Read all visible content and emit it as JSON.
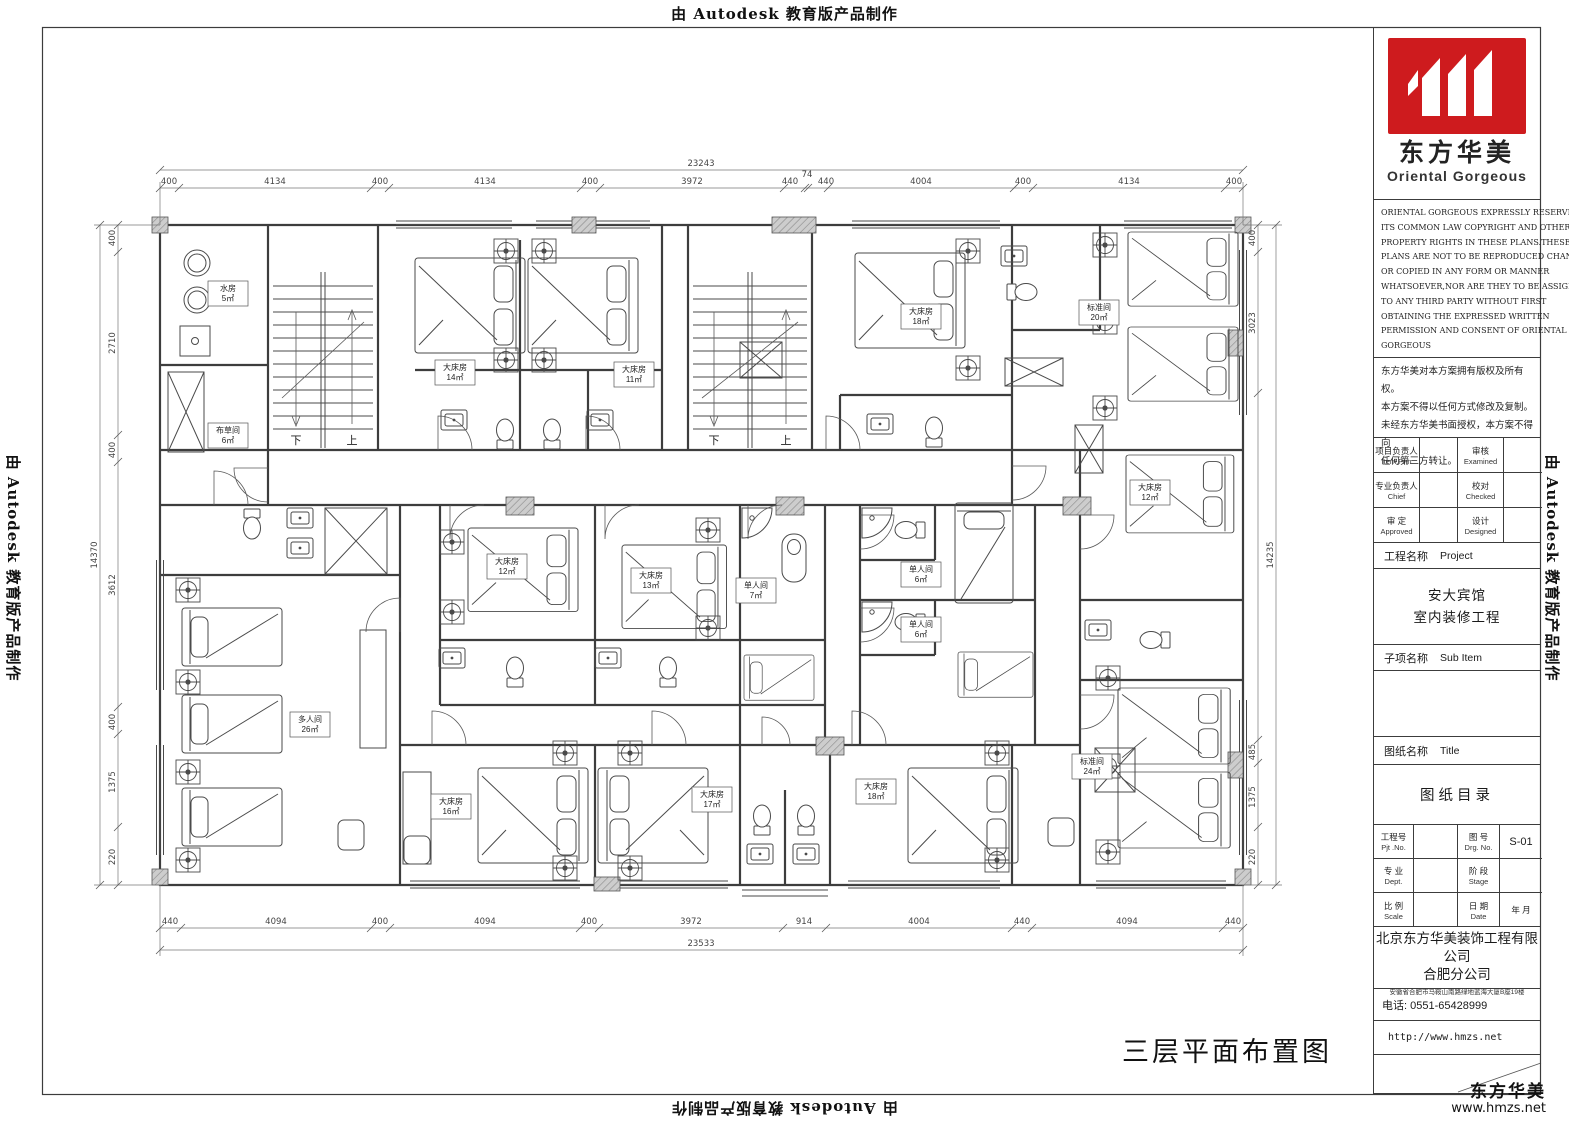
{
  "watermarks": {
    "top": "由 Autodesk 教育版产品制作",
    "bottom": "由 Autodesk 教育版产品制作",
    "left": "由 Autodesk 教育版产品制作",
    "right": "由 Autodesk 教育版产品制作"
  },
  "title_block": {
    "brand_cn": "东方华美",
    "brand_en": "Oriental Gorgeous",
    "logo_color": "#ce1b1e",
    "copyright_en": [
      "ORIENTAL GORGEOUS EXPRESSLY RESERVES",
      "ITS COMMON LAW COPYRIGHT AND OTHER",
      "PROPERTY RIGHTS IN THESE PLANS.THESE",
      "PLANS ARE NOT TO BE REPRODUCED CHANGED",
      "OR COPIED IN ANY FORM OR MANNER",
      "WHATSOEVER,NOR ARE THEY TO BE ASSIGHED",
      "TO ANY THIRD PARTY WITHOUT FIRST",
      "OBTAINING THE EXPRESSED WRITTEN",
      "PERMISSION AND CONSENT OF ORIENTAL",
      "GORGEOUS"
    ],
    "copyright_cn": [
      "东方华美对本方案拥有版权及所有权。",
      "本方案不得以任何方式修改及复制。",
      "未经东方华美书面授权，本方案不得向",
      "任何第三方转让。"
    ],
    "people": [
      {
        "l1": "项目负责人",
        "l1e": "Item.Prin",
        "l2": "审核",
        "l2e": "Examined"
      },
      {
        "l1": "专业负责人",
        "l1e": "Chief",
        "l2": "校对",
        "l2e": "Checked"
      },
      {
        "l1": "审 定",
        "l1e": "Approved",
        "l2": "设计",
        "l2e": "Designed"
      }
    ],
    "project_label_cn": "工程名称",
    "project_label_en": "Project",
    "project_name": [
      "安大宾馆",
      "室内装修工程"
    ],
    "subitem_label_cn": "子项名称",
    "subitem_label_en": "Sub Item",
    "sheet_label_cn": "图纸名称",
    "sheet_label_en": "Title",
    "sheet_name": "图纸目录",
    "grid": {
      "pjt_cn": "工程号",
      "pjt_en": "Pjt .No.",
      "drg_cn": "图 号",
      "drg_en": "Drg. No.",
      "drg_val": "S-01",
      "dept_cn": "专 业",
      "dept_en": "Dept.",
      "stage_cn": "阶 段",
      "stage_en": "Stage",
      "scale_cn": "比 例",
      "scale_en": "Scale",
      "date_cn": "日 期",
      "date_en": "Date",
      "date_val": "年  月"
    },
    "company": [
      "北京东方华美装饰工程有限公司",
      "合肥分公司"
    ],
    "address": "安徽省合肥市马鞍山南路绿地蓝海大厦B座19楼",
    "phone": "电话: 0551-65428999",
    "website": "http://www.hmzs.net"
  },
  "footer_brand": {
    "name": "东方华美",
    "url": "www.hmzs.net"
  },
  "drawing": {
    "caption": "三层平面布置图",
    "stair_down": "下",
    "stair_up": "上",
    "rooms": [
      {
        "name": "水房",
        "area": "5㎡"
      },
      {
        "name": "布草间",
        "area": "6㎡"
      },
      {
        "name": "大床房",
        "area": "14㎡"
      },
      {
        "name": "大床房",
        "area": "11㎡"
      },
      {
        "name": "大床房",
        "area": "18㎡"
      },
      {
        "name": "标准间",
        "area": "20㎡"
      },
      {
        "name": "大床房",
        "area": "12㎡"
      },
      {
        "name": "大床房",
        "area": "12㎡"
      },
      {
        "name": "大床房",
        "area": "13㎡"
      },
      {
        "name": "单人间",
        "area": "7㎡"
      },
      {
        "name": "单人间",
        "area": "6㎡"
      },
      {
        "name": "单人间",
        "area": "6㎡"
      },
      {
        "name": "多人间",
        "area": "26㎡"
      },
      {
        "name": "标准间",
        "area": "24㎡"
      },
      {
        "name": "大床房",
        "area": "16㎡"
      },
      {
        "name": "大床房",
        "area": "17㎡"
      },
      {
        "name": "大床房",
        "area": "18㎡"
      }
    ],
    "dims": {
      "top": [
        "400",
        "4134",
        "400",
        "4134",
        "400",
        "3972",
        "440",
        "74",
        "440",
        "4004",
        "400",
        "4134",
        "400"
      ],
      "top_total": "23243",
      "bottom": [
        "440",
        "4094",
        "400",
        "4094",
        "400",
        "3972",
        "914",
        "4004",
        "440",
        "4094",
        "440"
      ],
      "bottom_total": "23533",
      "left": [
        "400",
        "2710",
        "400",
        "3612",
        "400",
        "1375",
        "220"
      ],
      "left_total": "14370",
      "right": [
        "400",
        "3023",
        "485",
        "1375",
        "220"
      ],
      "right_total": "14235"
    }
  }
}
